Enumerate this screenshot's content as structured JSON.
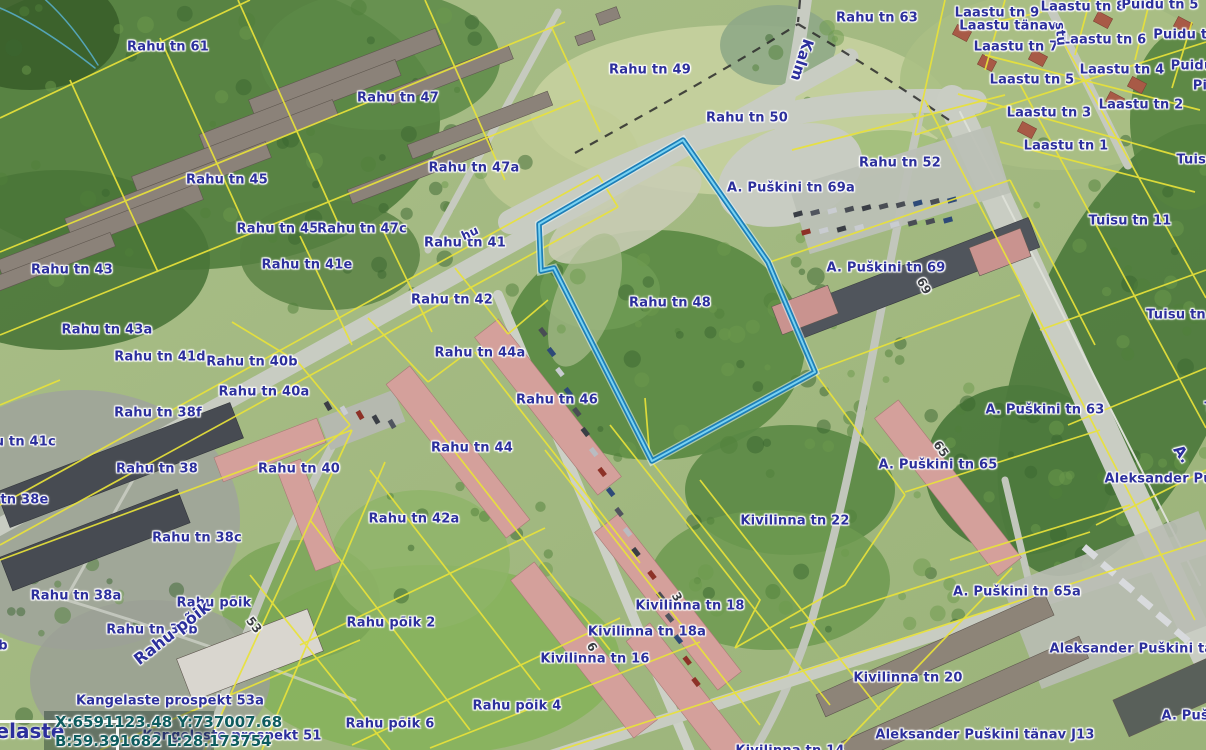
{
  "map": {
    "colors": {
      "label": "#2c2f9c",
      "cadastral_line": "#e8e23a",
      "highlight_outer": "#1d7fb8",
      "highlight_inner": "#79d2f2",
      "coords_text": "#0e5c5e"
    },
    "highlighted_parcel": {
      "name": "Rahu tn 48"
    },
    "overlay": {
      "coords_line1": "X:6591123.48 Y:737007.68",
      "coords_line2": "B:59.391682 L:28.173754",
      "clipped_street_label": "Kangelaste"
    },
    "labels": [
      {
        "t": "Rahu tn 61",
        "x": 168,
        "y": 47
      },
      {
        "t": "Rahu tn 47",
        "x": 398,
        "y": 98
      },
      {
        "t": "Rahu tn 49",
        "x": 650,
        "y": 70
      },
      {
        "t": "Rahu tn 63",
        "x": 877,
        "y": 18
      },
      {
        "t": "Laastu tn 9",
        "x": 997,
        "y": 13
      },
      {
        "t": "Laastu tn 8",
        "x": 1083,
        "y": 7
      },
      {
        "t": "Puidu tn 5",
        "x": 1160,
        "y": 5
      },
      {
        "t": "Laastu tänav",
        "x": 1008,
        "y": 26
      },
      {
        "t": "Laastu tn 7",
        "x": 1016,
        "y": 47
      },
      {
        "t": "Laastu tn 6",
        "x": 1104,
        "y": 40
      },
      {
        "t": "Puidu tn",
        "x": 1185,
        "y": 35
      },
      {
        "t": "Laastu tn 5",
        "x": 1032,
        "y": 80
      },
      {
        "t": "Laastu tn 4",
        "x": 1122,
        "y": 70
      },
      {
        "t": "Puidu",
        "x": 1192,
        "y": 66
      },
      {
        "t": "Pi",
        "x": 1200,
        "y": 86
      },
      {
        "t": "Laastu tn 3",
        "x": 1049,
        "y": 113
      },
      {
        "t": "Laastu tn 2",
        "x": 1141,
        "y": 105
      },
      {
        "t": "Laastu tn 1",
        "x": 1066,
        "y": 146
      },
      {
        "t": "Rahu tn 50",
        "x": 747,
        "y": 118
      },
      {
        "t": "Rahu tn 52",
        "x": 900,
        "y": 163
      },
      {
        "t": "Tuisu",
        "x": 1196,
        "y": 160
      },
      {
        "t": "Tuisu tn 11",
        "x": 1130,
        "y": 221
      },
      {
        "t": "Tuisu tn 1",
        "x": 1183,
        "y": 315
      },
      {
        "t": "Tuisu",
        "x": 1224,
        "y": 408
      },
      {
        "t": "Rahu tn 47a",
        "x": 474,
        "y": 168
      },
      {
        "t": "Rahu tn 45",
        "x": 227,
        "y": 180
      },
      {
        "t": "Rahu tn 45a",
        "x": 282,
        "y": 229
      },
      {
        "t": "Rahu tn 47c",
        "x": 362,
        "y": 229
      },
      {
        "t": "Rahu tn 41",
        "x": 465,
        "y": 243
      },
      {
        "t": "Rahu tn 41e",
        "x": 307,
        "y": 265
      },
      {
        "t": "Rahu tn 43",
        "x": 72,
        "y": 270
      },
      {
        "t": "A. Puškini tn 69a",
        "x": 791,
        "y": 188
      },
      {
        "t": "A. Puškini tn 69",
        "x": 886,
        "y": 268
      },
      {
        "t": "Rahu tn 48",
        "x": 670,
        "y": 303
      },
      {
        "t": "Rahu tn 42",
        "x": 452,
        "y": 300
      },
      {
        "t": "Rahu tn 43a",
        "x": 107,
        "y": 330
      },
      {
        "t": "Rahu tn 41d",
        "x": 160,
        "y": 357
      },
      {
        "t": "Rahu tn 40b",
        "x": 252,
        "y": 362
      },
      {
        "t": "Rahu tn 44a",
        "x": 480,
        "y": 353
      },
      {
        "t": "Rahu tn 40a",
        "x": 264,
        "y": 392
      },
      {
        "t": "Rahu tn 38f",
        "x": 158,
        "y": 413
      },
      {
        "t": "Rahu tn 46",
        "x": 557,
        "y": 400
      },
      {
        "t": "A. Puškini tn 63",
        "x": 1045,
        "y": 410
      },
      {
        "t": "Rahu tn 41c",
        "x": 11,
        "y": 442
      },
      {
        "t": "Rahu tn 38",
        "x": 157,
        "y": 469
      },
      {
        "t": "Rahu tn 40",
        "x": 299,
        "y": 469
      },
      {
        "t": "A. Puškini tn 65",
        "x": 938,
        "y": 465
      },
      {
        "t": "Aleksander Puškini tänav",
        "x": 1200,
        "y": 479
      },
      {
        "t": "Rahu tn 38e",
        "x": 3,
        "y": 500
      },
      {
        "t": "Kivilinna tn 22",
        "x": 795,
        "y": 521
      },
      {
        "t": "Rahu tn 42a",
        "x": 414,
        "y": 519
      },
      {
        "t": "Rahu tn 38c",
        "x": 197,
        "y": 538
      },
      {
        "t": "A. Puškini tn 65a",
        "x": 1017,
        "y": 592
      },
      {
        "t": "Rahu tn 38a",
        "x": 76,
        "y": 596
      },
      {
        "t": "Rahu põik",
        "x": 214,
        "y": 603
      },
      {
        "t": "Kivilinna tn 18",
        "x": 690,
        "y": 606
      },
      {
        "t": "Rahu põik 2",
        "x": 391,
        "y": 623
      },
      {
        "t": "Kivilinna tn 18a",
        "x": 647,
        "y": 632
      },
      {
        "t": "Rahu tn 38b",
        "x": 152,
        "y": 630
      },
      {
        "t": "b",
        "x": 3,
        "y": 646
      },
      {
        "t": "Kivilinna tn 16",
        "x": 595,
        "y": 659
      },
      {
        "t": "Kivilinna tn 20",
        "x": 908,
        "y": 678
      },
      {
        "t": "Aleksander Puškini tänav",
        "x": 1145,
        "y": 649
      },
      {
        "t": "A. Puškini",
        "x": 1199,
        "y": 716
      },
      {
        "t": "Kangelaste prospekt 53a",
        "x": 170,
        "y": 701
      },
      {
        "t": "Rahu põik 4",
        "x": 517,
        "y": 706
      },
      {
        "t": "Rahu põik 6",
        "x": 390,
        "y": 724
      },
      {
        "t": "Kangelaste prospekt 51",
        "x": 232,
        "y": 736
      },
      {
        "t": "Aleksander Puškini tänav J13",
        "x": 985,
        "y": 735
      },
      {
        "t": "Kivilinna tn 14",
        "x": 790,
        "y": 751
      },
      {
        "t": "Rahu tn 44",
        "x": 472,
        "y": 448
      },
      {
        "t": "Kalm",
        "x": 802,
        "y": 60,
        "r": 108,
        "s": 15
      },
      {
        "t": "stu",
        "x": 1060,
        "y": 34,
        "r": 85,
        "s": 13
      },
      {
        "t": "hu",
        "x": 470,
        "y": 233,
        "r": -25,
        "s": 12
      },
      {
        "t": "Rahu põik",
        "x": 172,
        "y": 633,
        "r": -38,
        "s": 16
      },
      {
        "t": "A.",
        "x": 1182,
        "y": 454,
        "r": 55,
        "s": 15
      },
      {
        "t": "69",
        "x": 924,
        "y": 286,
        "r": 62,
        "c": "num"
      },
      {
        "t": "65",
        "x": 941,
        "y": 449,
        "r": 55,
        "c": "num"
      },
      {
        "t": "53",
        "x": 254,
        "y": 625,
        "r": 52,
        "c": "num"
      },
      {
        "t": "6",
        "x": 592,
        "y": 647,
        "r": 60,
        "c": "num"
      },
      {
        "t": "3",
        "x": 677,
        "y": 597,
        "r": 60,
        "c": "num"
      }
    ]
  }
}
